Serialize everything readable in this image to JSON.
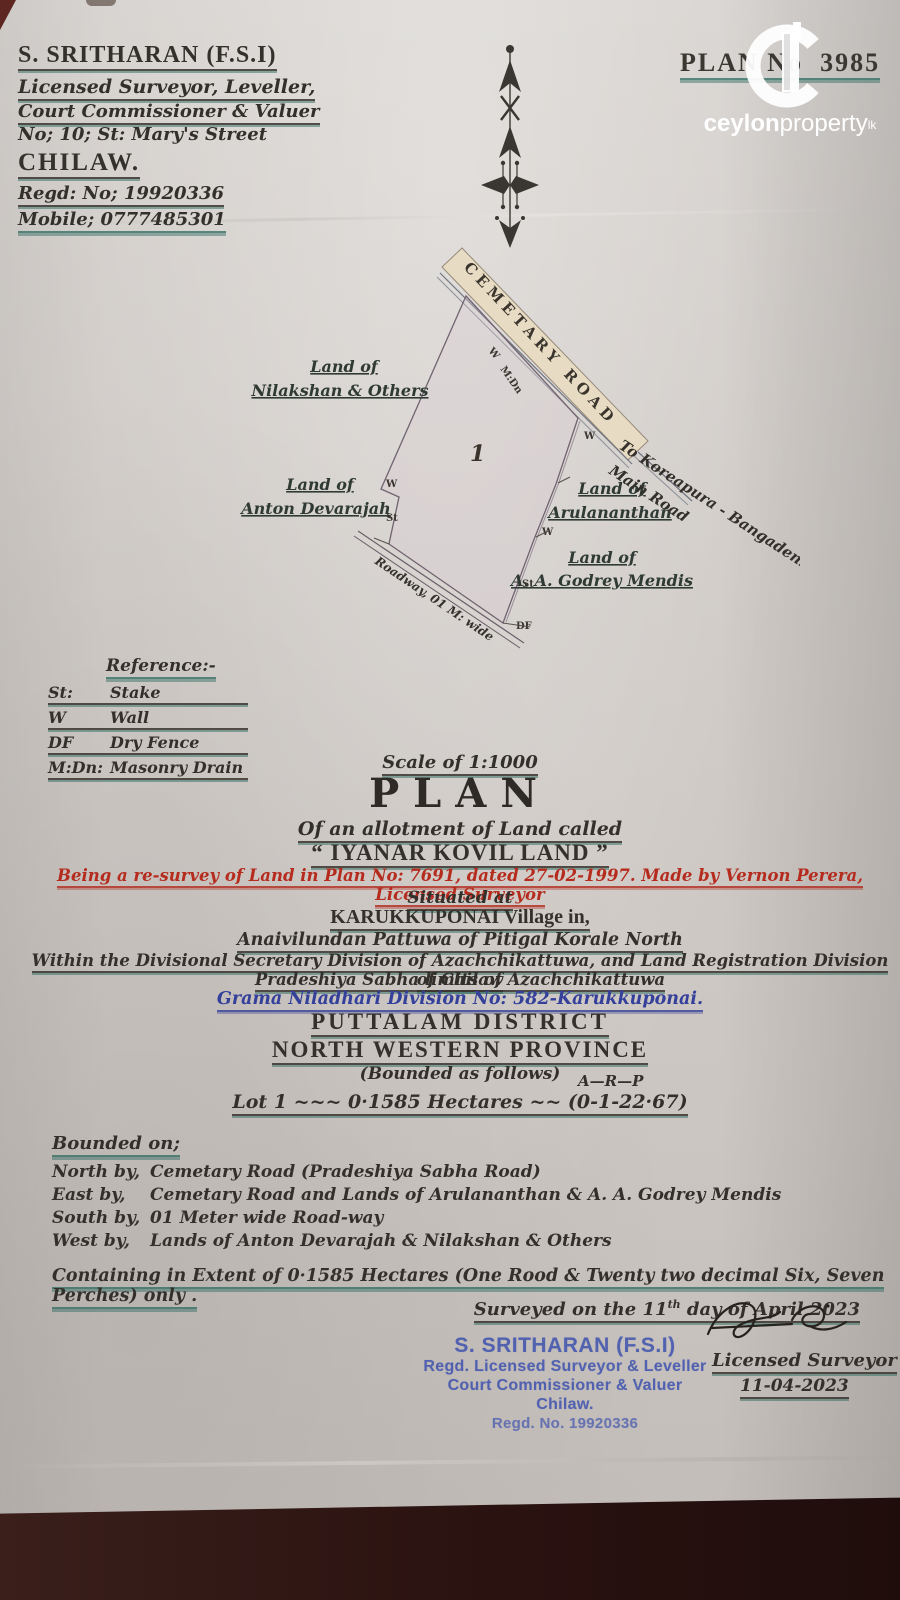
{
  "colors": {
    "paper": "#d0cbc7",
    "background": "#2a1210",
    "ink": "#33302b",
    "teal_underline": "#2c6b5f",
    "red_ink": "#b52c1e",
    "blue_ink": "#34409a",
    "stamp_blue": "#3f53ae",
    "road_fill": "#e7dcc3"
  },
  "surveyor_card": {
    "name": "S. SRITHARAN (F.S.I)",
    "line1": "Licensed Surveyor, Leveller,",
    "line2": "Court Commissioner & Valuer",
    "line3": "No; 10; St: Mary's Street",
    "city": "CHILAW.",
    "regd": "Regd: No; 19920336",
    "mobile": "Mobile; 0777485301"
  },
  "plan_header": {
    "label": "PLAN No",
    "number": "3985"
  },
  "watermark": {
    "brand_bold": "ceylon",
    "brand_light": "property",
    "tld": "lk"
  },
  "drawing": {
    "road_label": "CEMETARY ROAD",
    "to_road_line1": "To Koreapura - Bangadeniya",
    "to_road_line2": "Main Road",
    "lot_number": "1",
    "roadway_label": "Roadway, 01 M: wide",
    "neighbor_nw1": "Land of",
    "neighbor_nw2": "Nilakshan & Others",
    "neighbor_w1": "Land of",
    "neighbor_w2": "Anton Devarajah",
    "neighbor_e1": "Land of",
    "neighbor_e2": "Arulananthan",
    "neighbor_se1": "Land of",
    "neighbor_se2": "A. A. Godrey Mendis",
    "mark_w": "W",
    "mark_mdn": "M:Dn",
    "mark_st": "St",
    "mark_df": "DF"
  },
  "references": {
    "title": "Reference:-",
    "items": [
      {
        "abbr": "St:",
        "meaning": "Stake"
      },
      {
        "abbr": "W",
        "meaning": "Wall"
      },
      {
        "abbr": "DF",
        "meaning": "Dry Fence"
      },
      {
        "abbr": "M:Dn:",
        "meaning": "Masonry Drain"
      }
    ]
  },
  "title_block": {
    "scale": "Scale of 1:1000",
    "plan": "PLAN",
    "allotment": "Of an allotment of Land called",
    "land_name": "“ IYANAR KOVIL LAND ”",
    "resurvey_note": "Being a re-survey of Land in Plan No: 7691, dated 27-02-1997. Made by Vernon Perera, Licensed Surveyor",
    "situated": "Situated at",
    "village": "KARUKKUPONAI Village in,",
    "pattuwa": "Anaivilundan Pattuwa of Pitigal Korale North",
    "division": "Within the Divisional Secretary Division of Azachchikattuwa, and Land Registration Division of Chilaw",
    "sabha": "Pradeshiya Sabha limits of Azachchikattuwa",
    "gn_division": "Grama Niladhari Division No: 582-Karukkuponai.",
    "district": "PUTTALAM DISTRICT",
    "province": "NORTH WESTERN PROVINCE",
    "bounded_note": "(Bounded as follows)"
  },
  "extent": {
    "arp_header": "A—R—P",
    "lot_line": "Lot 1 ~~~ 0·1585 Hectares ~~ (0-1-22·67)"
  },
  "bounded": {
    "heading": "Bounded on;",
    "rows": [
      {
        "side": "North by,",
        "desc": "Cemetary Road (Pradeshiya Sabha Road)"
      },
      {
        "side": "East by,",
        "desc": "Cemetary Road and Lands of Arulananthan & A. A. Godrey Mendis"
      },
      {
        "side": "South by,",
        "desc": "01 Meter wide Road-way"
      },
      {
        "side": "West by,",
        "desc": "Lands of Anton Devarajah & Nilakshan & Others"
      }
    ]
  },
  "containing": "Containing in Extent of 0·1585 Hectares (One Rood & Twenty two decimal Six, Seven Perches) only .",
  "surveyed": {
    "pre": "Surveyed on the ",
    "day": "11",
    "sup": "th",
    "post": " day of April 2023"
  },
  "stamp": {
    "name": "S. SRITHARAN (F.S.I)",
    "line1": "Regd. Licensed Surveyor & Leveller",
    "line2": "Court Commissioner & Valuer",
    "line3": "Chilaw.",
    "line4": "Regd. No. 19920336"
  },
  "signature_block": {
    "title": "Licensed Surveyor",
    "date": "11-04-2023"
  }
}
